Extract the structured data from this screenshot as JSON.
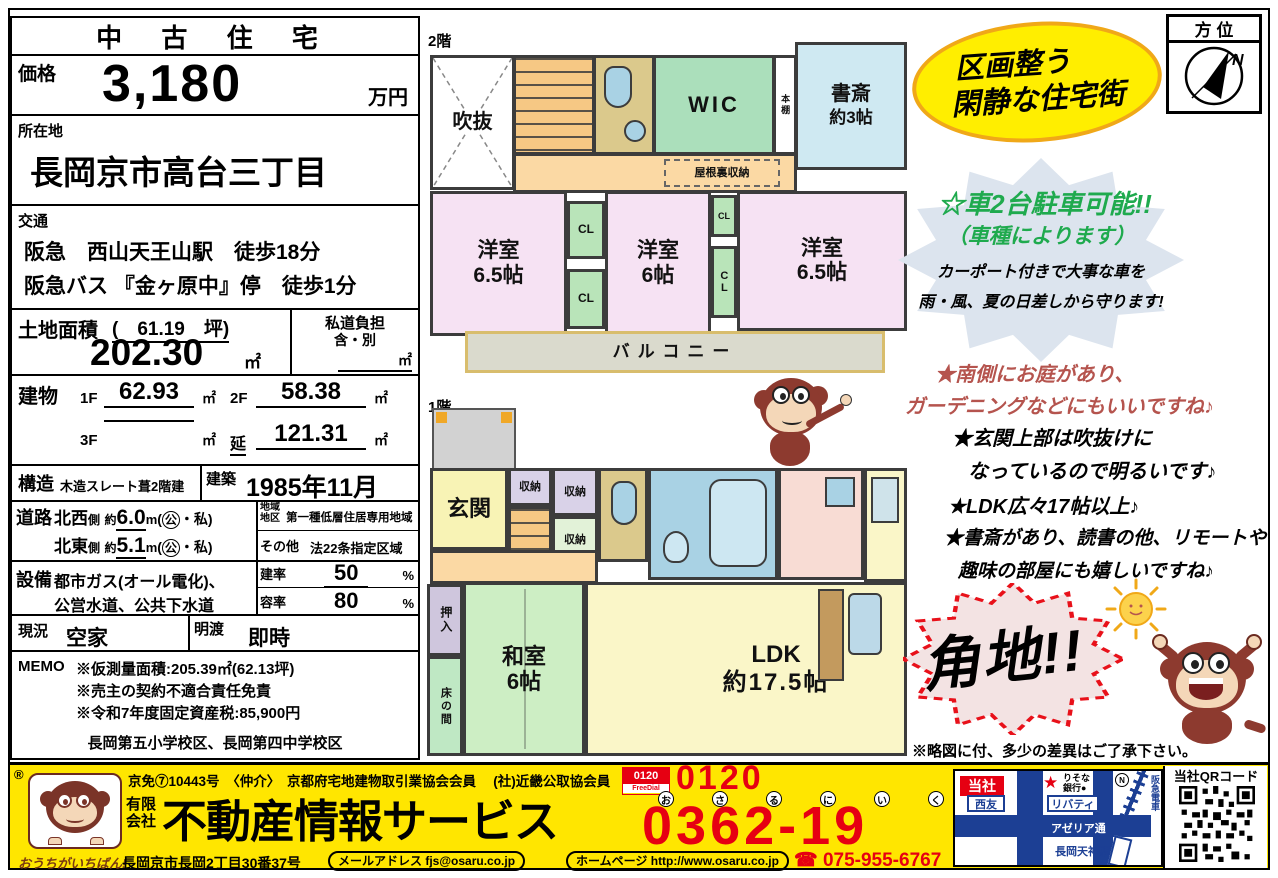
{
  "left_panel": {
    "title": "中 古 住 宅",
    "price": {
      "label": "価格",
      "value": "3,180",
      "unit": "万円"
    },
    "location": {
      "label": "所在地",
      "value": "長岡京市高台三丁目"
    },
    "access": {
      "label": "交通",
      "line1": "阪急　西山天王山駅　徒歩18分",
      "line2": "阪急バス 『金ヶ原中』停　徒歩1分"
    },
    "land": {
      "label": "土地面積",
      "tsubo": "(　61.19　坪)",
      "value": "202.30",
      "unit": "㎡"
    },
    "private_road": {
      "label": "私道負担",
      "value": "含・別",
      "unit": "㎡"
    },
    "building": {
      "label": "建物",
      "f1_label": "1F",
      "f1": "62.93",
      "f2_label": "2F",
      "f2": "58.38",
      "f3_label": "3F",
      "f3": "",
      "total_label": "延",
      "total": "121.31",
      "unit": "㎡"
    },
    "structure": {
      "label": "構造",
      "value": "木造スレート葺2階建"
    },
    "built": {
      "label": "建築",
      "value": "1985年11月"
    },
    "road": {
      "label": "道路",
      "rows": [
        {
          "side": "北西",
          "side_suffix": "側",
          "approx": "約",
          "width": "6.0",
          "unit": "m",
          "kind_open": "(",
          "kind_circled": "公",
          "kind_rest": "・私)"
        },
        {
          "side": "北東",
          "side_suffix": "側",
          "approx": "約",
          "width": "5.1",
          "unit": "m",
          "kind_open": "(",
          "kind_circled": "公",
          "kind_rest": "・私)"
        }
      ]
    },
    "district": {
      "label1": "地域",
      "label2": "地区",
      "value": "第一種低層住居専用地域"
    },
    "other": {
      "label": "その他",
      "value": "法22条指定区域"
    },
    "facilities": {
      "label": "設備",
      "line1": "都市ガス(オール電化)、",
      "line2": "公営水道、公共下水道"
    },
    "bcr": {
      "label": "建率",
      "value": "50",
      "unit": "%"
    },
    "far": {
      "label": "容率",
      "value": "80",
      "unit": "%"
    },
    "status": {
      "label": "現況",
      "value": "空家"
    },
    "handover": {
      "label": "明渡",
      "value": "即時"
    },
    "memo": {
      "label": "MEMO",
      "line1": "※仮測量面積:205.39㎡(62.13坪)",
      "line2": "※売主の契約不適合責任免責",
      "line3": "※令和7年度固定資産税:85,900円",
      "schools": "長岡第五小学校区、長岡第四中学校区"
    }
  },
  "floorplan_2f": {
    "floor_label": "2階",
    "rooms": {
      "void": "吹抜",
      "wic": "WIC",
      "bookshelf": "本棚",
      "study": "書斎",
      "study_area": "約3帖",
      "attic": "屋根裏収納",
      "bed1": "洋室",
      "bed1_area": "6.5帖",
      "bed2": "洋室",
      "bed2_area": "6帖",
      "bed3": "洋室",
      "bed3_area": "6.5帖",
      "cl": "CL",
      "balcony": "バルコニー"
    }
  },
  "floorplan_1f": {
    "floor_label": "1階",
    "rooms": {
      "entrance": "玄関",
      "storage": "収納",
      "oshiire": "押入",
      "washitsu": "和室",
      "washitsu_area": "6帖",
      "tokonoma": "床の間",
      "ldk": "LDK",
      "ldk_area": "約17.5帖"
    }
  },
  "right_panel": {
    "compass_label": "方 位",
    "compass_n": "N",
    "catch_line1": "区画整う",
    "catch_line2": "閑静な住宅街",
    "parking_line1": "☆車2台駐車可能!!",
    "parking_line2": "（車種によります）",
    "parking_line3": "カーポート付きで大事な車を",
    "parking_line4": "雨・風、夏の日差しから守ります!",
    "point_red1": "★南側にお庭があり、",
    "point_red2": "ガーデニングなどにもいいですね♪",
    "point1a": "★玄関上部は吹抜けに",
    "point1b": "なっているので明るいです♪",
    "point2": "★LDK広々17帖以上♪",
    "point3a": "★書斎があり、読書の他、リモートや",
    "point3b": "趣味の部屋にも嬉しいですね♪",
    "corner_lot": "角地!!",
    "disclaimer": "※略図に付、多少の差異はご了承下さい。"
  },
  "footer": {
    "reg_mark": "®",
    "tagline": "おうちがいちばん!",
    "license": "京免⑦10443号　〈仲介〉　京都府宅地建物取引業協会会員　 (社)近畿公取協会員",
    "company_prefix1": "有限",
    "company_prefix2": "会社",
    "company_name": "不動産情報サービス",
    "address": "長岡京市長岡2丁目30番37号",
    "email": "メールアドレス fjs@osaru.co.jp",
    "website": "ホームページ http://www.osaru.co.jp",
    "freedial_logo_top": "0120",
    "freedial_logo_sub": "FreeDial",
    "phone_top": "0120",
    "furigana": [
      "お",
      "さ",
      "る",
      "に",
      "い",
      "く"
    ],
    "phone_main": "0362-19",
    "tel": "☎ 075-955-6767",
    "map": {
      "company": "当社",
      "star": "★",
      "bank": "りそな\n銀行●",
      "seiyu": "西友",
      "liberty": "リバティ",
      "azeria": "アゼリア通",
      "station": "長岡天神駅",
      "railway": "阪急電車",
      "north": "N"
    },
    "qr_label": "当社QRコード"
  },
  "colors": {
    "accent_red": "#e60012",
    "bar_yellow": "#ffe600",
    "map_blue": "#1c3f94",
    "green_text": "#1faa4e",
    "brick_text": "#b5544e",
    "catch_yellow": "#ffee00"
  }
}
